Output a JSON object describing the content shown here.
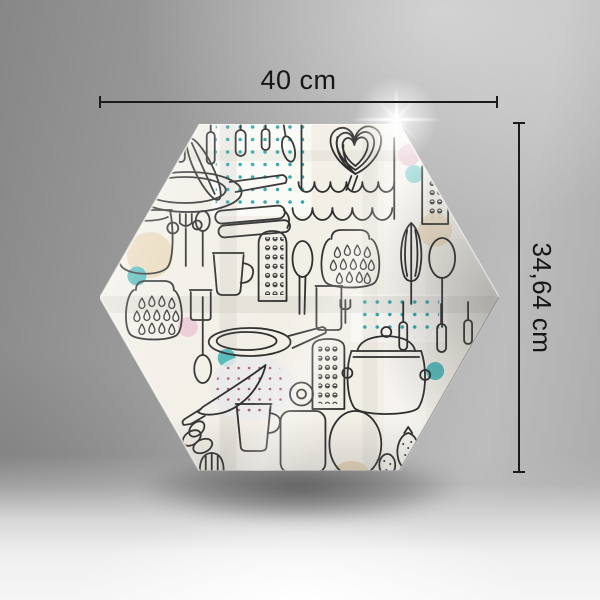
{
  "scene": {
    "description": "studio product shot of a hexagonal glass kitchen board with doodle pattern and size annotations"
  },
  "dimension_annotations": {
    "width": {
      "label": "40 cm"
    },
    "height": {
      "label": "34,64 cm"
    }
  },
  "board": {
    "shape": "regular-hexagon",
    "palette": {
      "base": "#f2efe7",
      "doodle_line": "#2d2d2d",
      "accent_teal": "#54b9bb",
      "teal_dots": "#2fa3a6",
      "accent_beige": "#e8d7b8",
      "accent_pink": "#ecc9d4",
      "pink_dots": "#a85f6b",
      "annotation": "#1b1b1b",
      "backdrop_gray": "#a6a6a6"
    },
    "motifs": [
      "frying-pan",
      "saucepan",
      "stock-pot",
      "grater",
      "fork",
      "spoon",
      "ladle",
      "knife",
      "mug",
      "drinking-glass",
      "storage-jar",
      "whisk-heart",
      "cake-waves",
      "citrus-reamer",
      "spatula",
      "cutting-board",
      "oval-plate",
      "strawberry",
      "hanging-utensils",
      "garlic-bulbs",
      "polka-dot-patches",
      "wooden-spoon"
    ]
  }
}
